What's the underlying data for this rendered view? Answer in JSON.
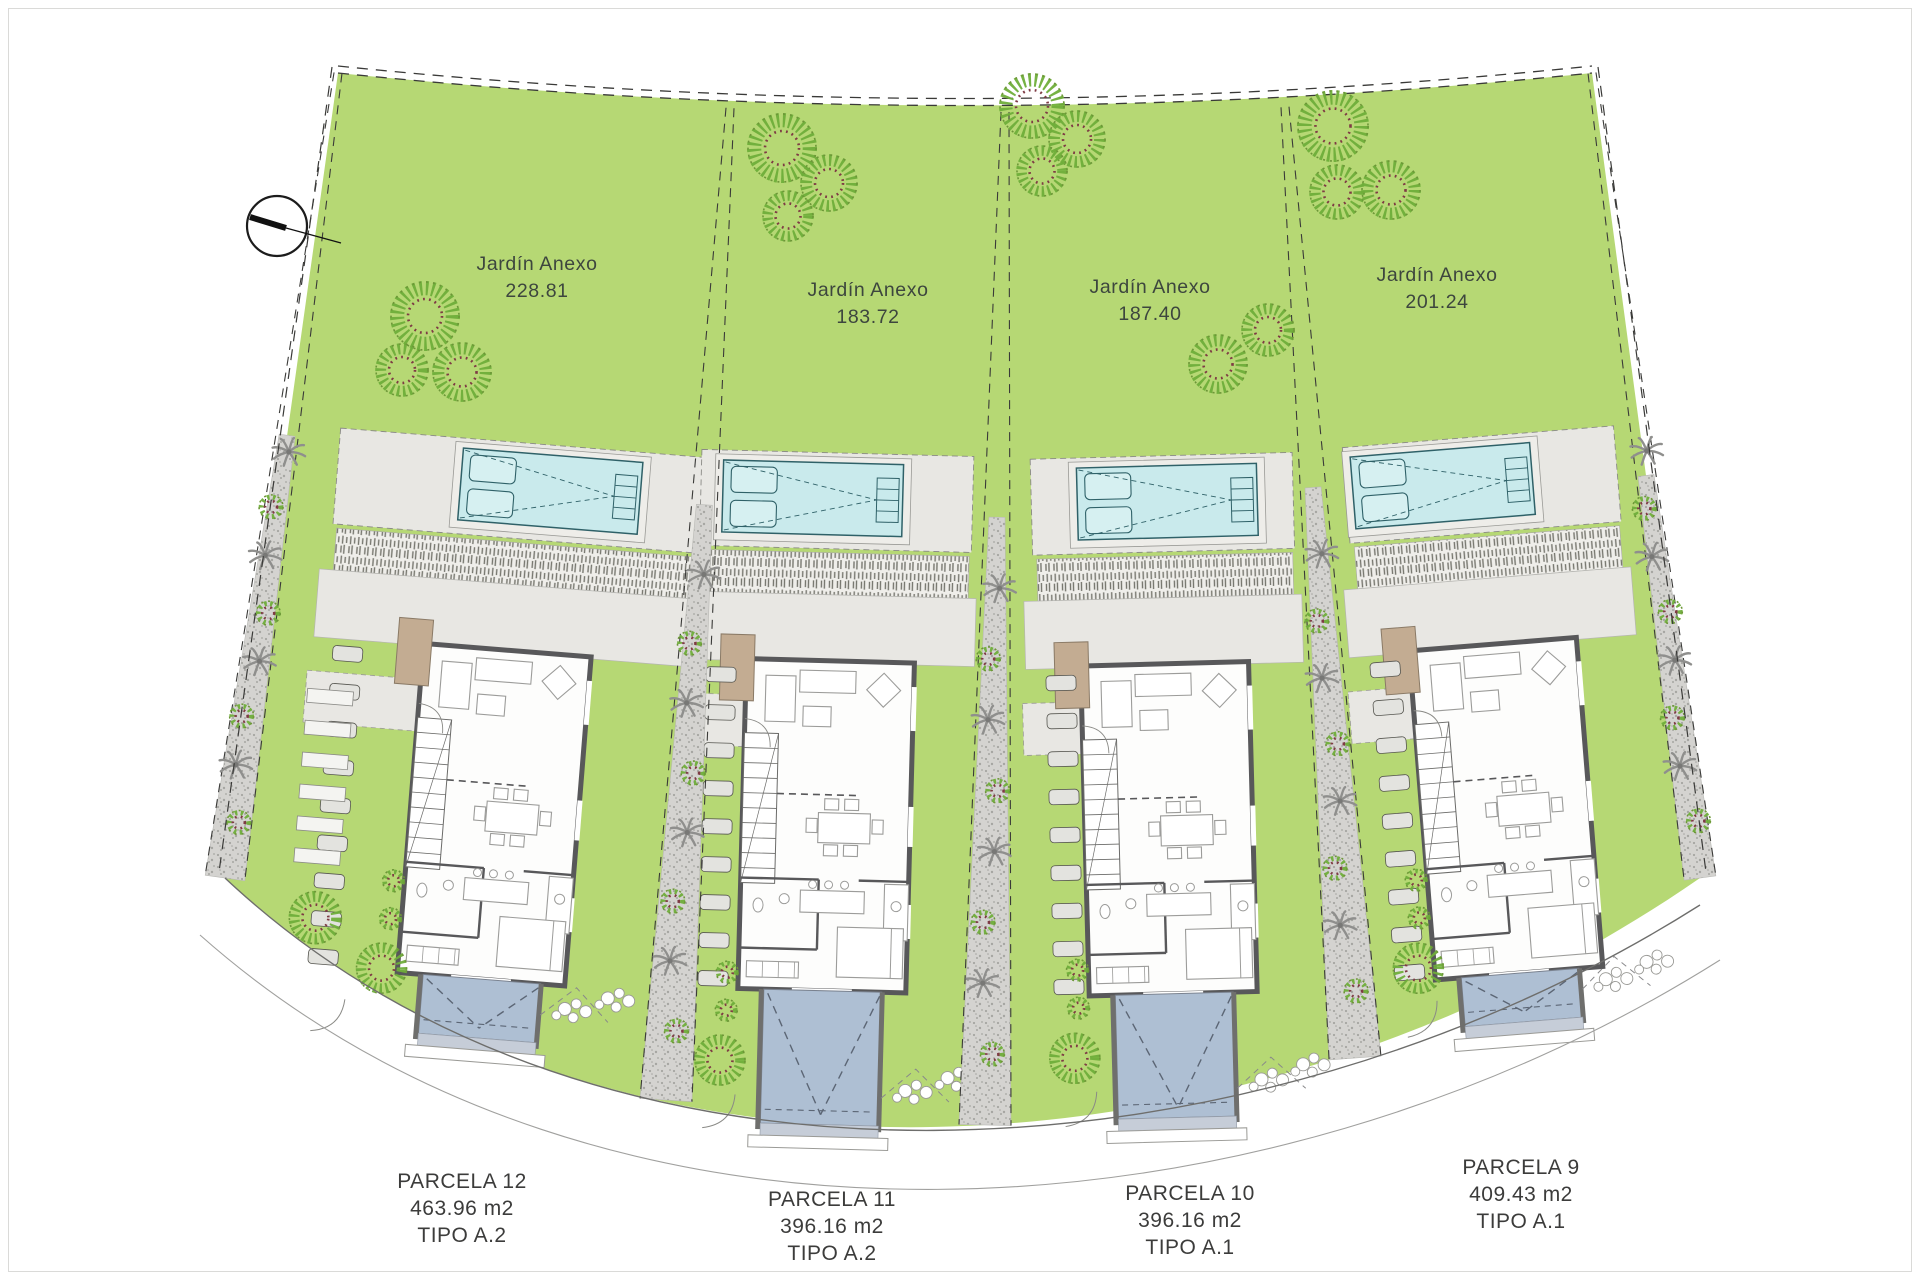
{
  "title": "Plano de parcelas - Villas",
  "compass": {
    "icon": "north-arrow"
  },
  "gardens": [
    {
      "parcel": "12",
      "label": "Jardín Anexo",
      "area": "228.81"
    },
    {
      "parcel": "11",
      "label": "Jardín Anexo",
      "area": "183.72"
    },
    {
      "parcel": "10",
      "label": "Jardín Anexo",
      "area": "187.40"
    },
    {
      "parcel": "9",
      "label": "Jardín Anexo",
      "area": "201.24"
    }
  ],
  "parcels": [
    {
      "id": "12",
      "label": "PARCELA 12",
      "area": "463.96 m2",
      "tipo": "TIPO A.2"
    },
    {
      "id": "11",
      "label": "PARCELA 11",
      "area": "396.16 m2",
      "tipo": "TIPO A.2"
    },
    {
      "id": "10",
      "label": "PARCELA 10",
      "area": "396.16 m2",
      "tipo": "TIPO A.1"
    },
    {
      "id": "9",
      "label": "PARCELA 9",
      "area": "409.43 m2",
      "tipo": "TIPO A.1"
    }
  ],
  "colors": {
    "grass": "#b6d874",
    "pool_water": "#c9eaec",
    "pool_line": "#2f6168",
    "paving": "#e8e7e3",
    "house_wall": "#58585a",
    "house_floor": "#fdfdfc",
    "furniture_line": "#9c9c9a",
    "driveway": "#aebfd3",
    "driveway_line": "#5c6675",
    "gravel": "#d4d3d0",
    "palm": "#8f8f8d",
    "bush_green": "#6fae3a",
    "bush_red": "#7e3b44",
    "deck_tan": "#c3ac92",
    "stone": "#e3e3df",
    "text_dark": "#3c3c3b",
    "text_garden": "#3d463e",
    "line": "#3a3a38"
  }
}
